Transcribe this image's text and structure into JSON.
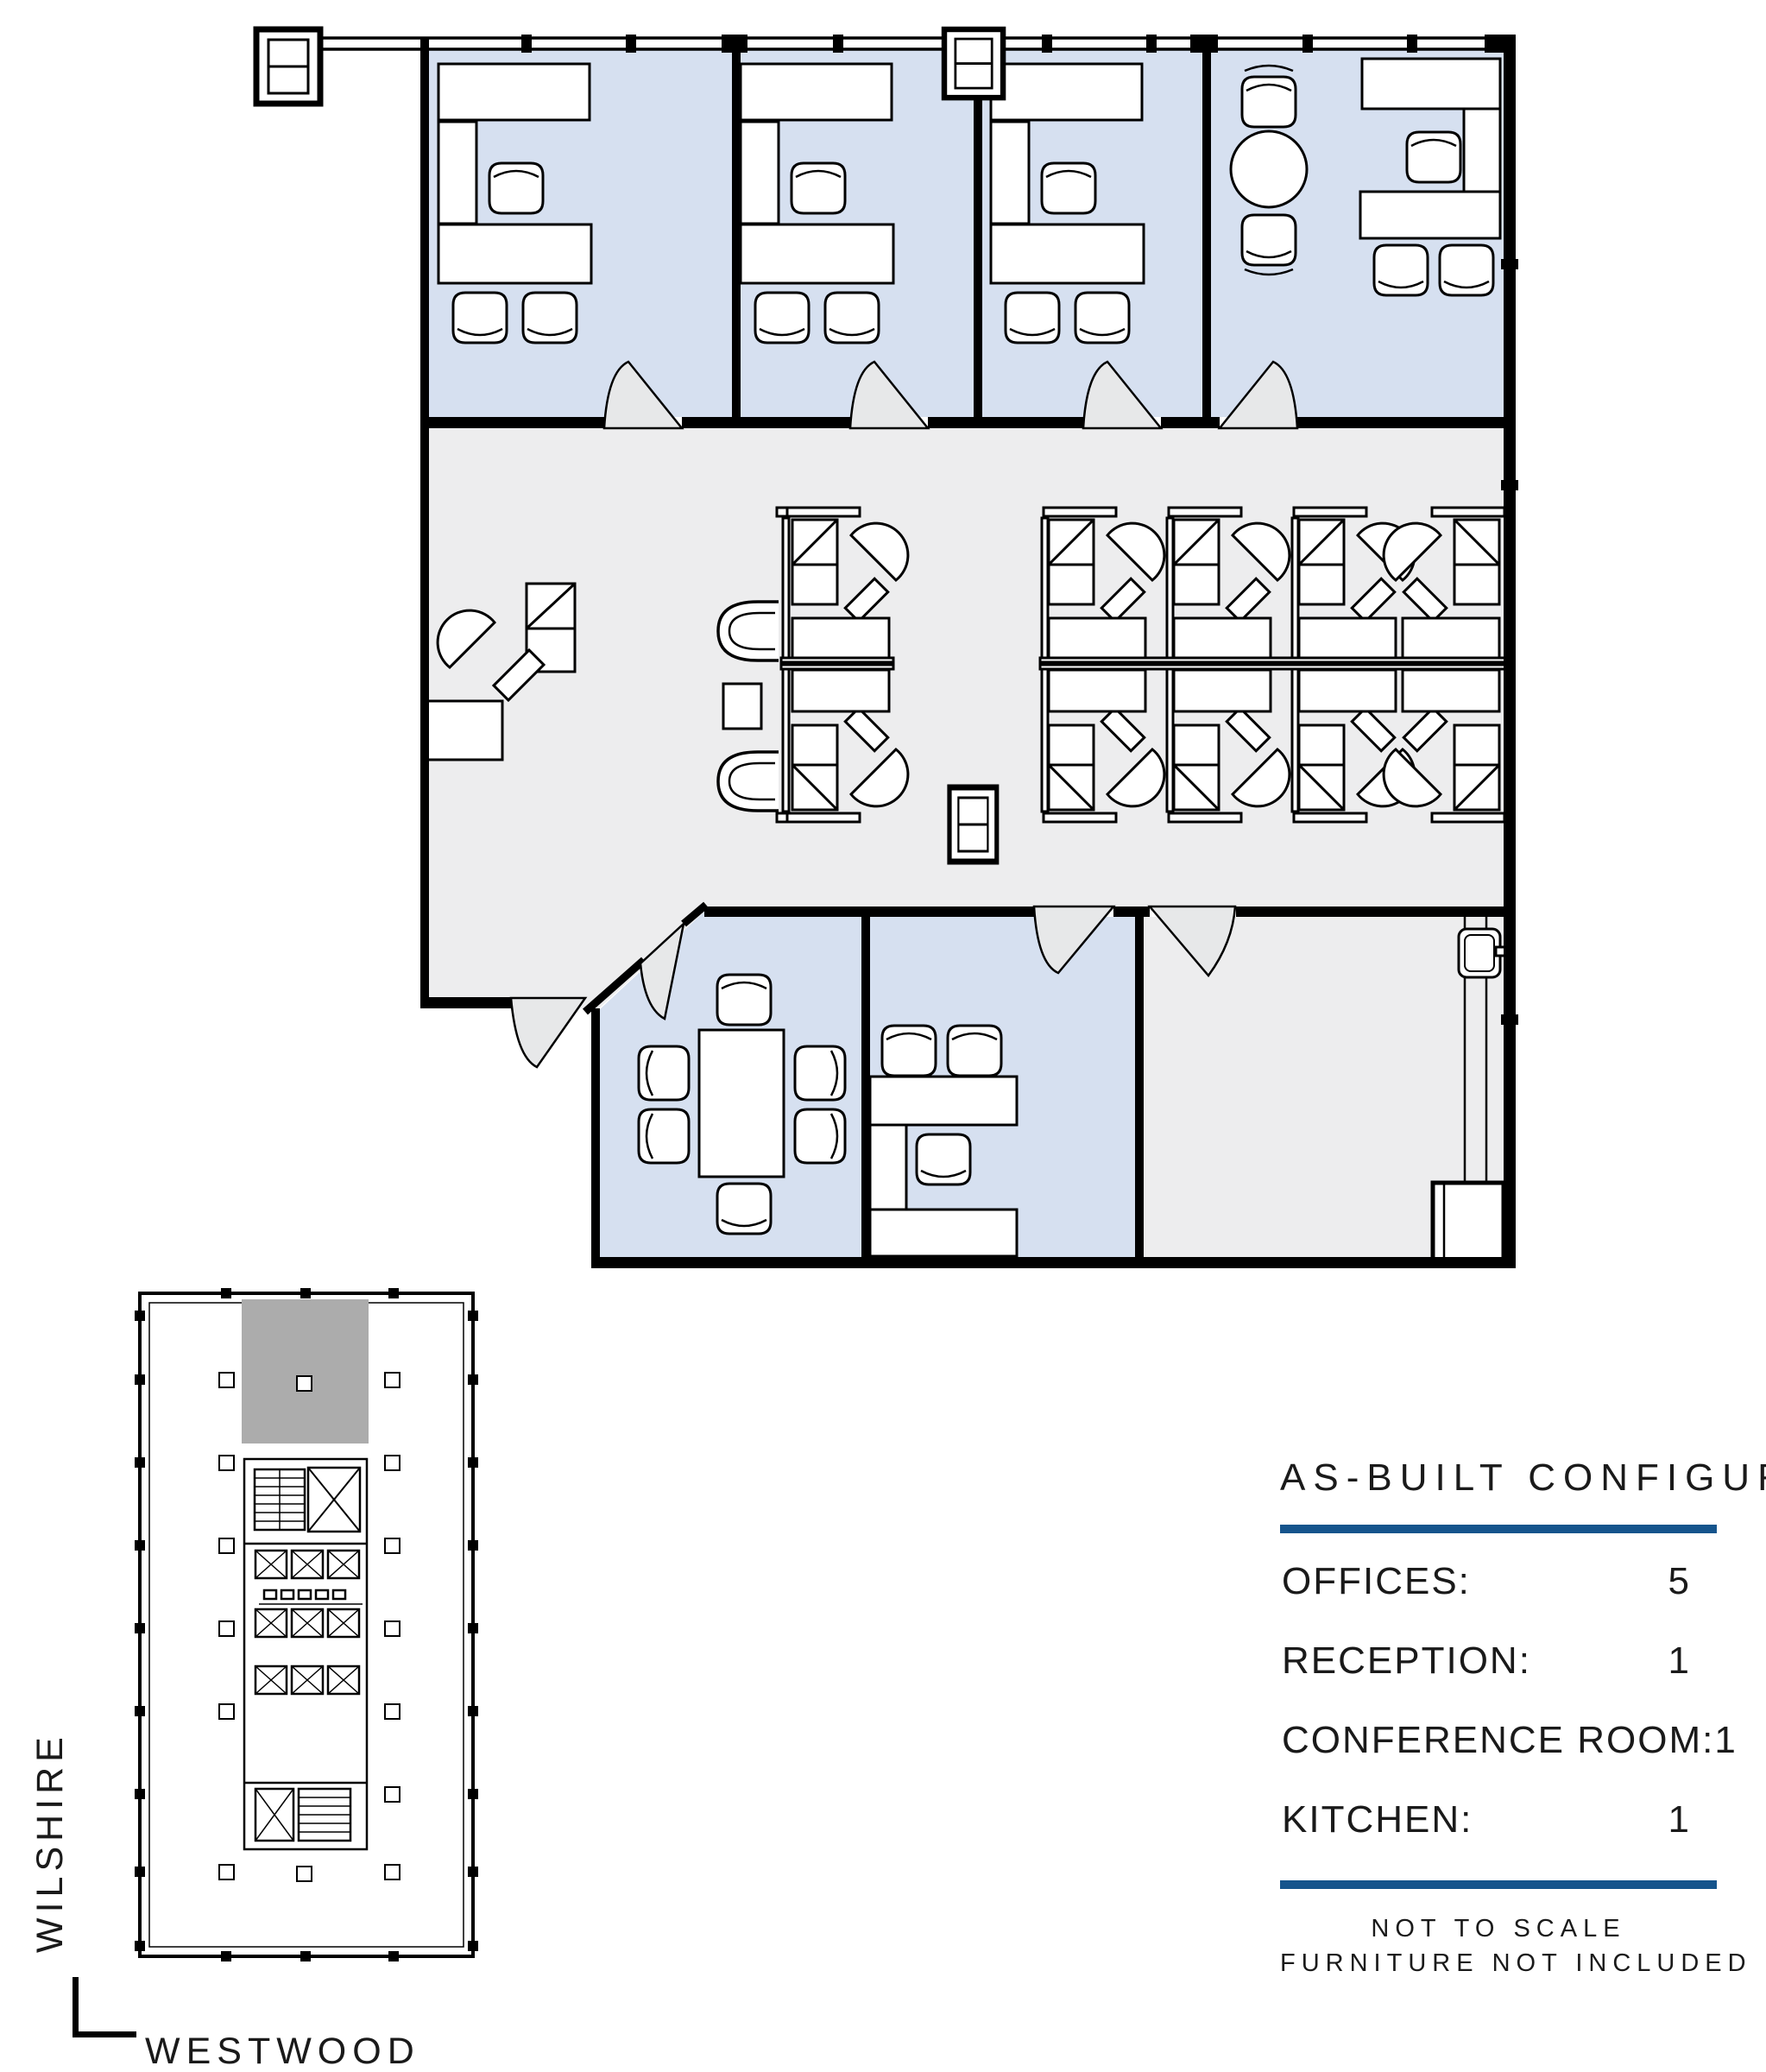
{
  "floor_plan": {
    "office_fill": "#D6E0F0",
    "open_area_fill": "#EDEDEE",
    "door_fill": "#E7E8E9",
    "wall_color": "#000000",
    "furniture_fill": "#FFFFFF"
  },
  "key_plan": {
    "highlight_fill": "#ACACAC",
    "street_vertical": "WILSHIRE",
    "street_horizontal": "WESTWOOD"
  },
  "legend": {
    "title": "AS-BUILT CONFIGURATION",
    "rule_color": "#15548C",
    "rows": [
      {
        "label": "OFFICES:",
        "value": "5"
      },
      {
        "label": "RECEPTION:",
        "value": "1"
      },
      {
        "label": "CONFERENCE ROOM:",
        "value": "1"
      },
      {
        "label": "KITCHEN:",
        "value": "1"
      }
    ],
    "notes": [
      "NOT TO SCALE",
      "FURNITURE NOT INCLUDED"
    ]
  },
  "icons": {
    "task-chair-icon": "rounded-square chair glyph",
    "cubicle-chair-icon": "teardrop fan chair glyph",
    "lounge-chair-icon": "C-shaped chair glyph",
    "round-table-icon": "circle table glyph",
    "column-marker-icon": "double square column symbol",
    "elevator-icon": "box with X",
    "stair-icon": "box with treads",
    "sink-icon": "rounded basin with faucet",
    "door-swing-icon": "quarter-arc door leaf"
  }
}
